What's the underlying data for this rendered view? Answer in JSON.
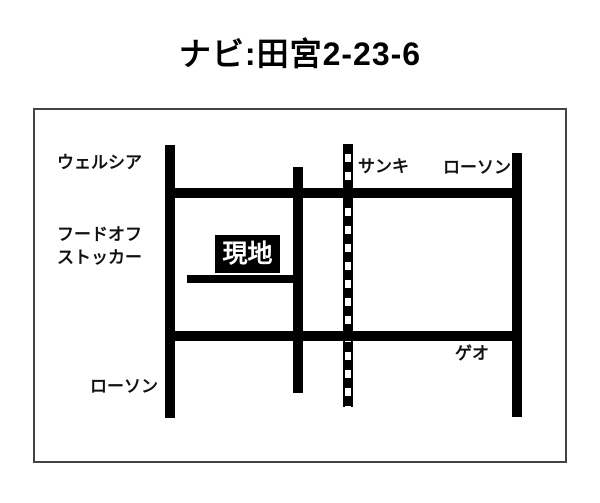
{
  "title": "ナビ:田宮2-23-6",
  "map": {
    "destination": {
      "label": "現地"
    },
    "landmarks": {
      "welcia": {
        "label": "ウェルシア"
      },
      "food_off_stocker": {
        "label_line1": "フードオフ",
        "label_line2": "ストッカー"
      },
      "lawson_bottom_left": {
        "label": "ローソン"
      },
      "sanki": {
        "label": "サンキ"
      },
      "lawson_top_right": {
        "label": "ローソン"
      },
      "geo": {
        "label": "ゲオ"
      }
    },
    "colors": {
      "background": "#ffffff",
      "road": "#000000",
      "railway": "#000000",
      "text": "#111111",
      "destination_bg": "#000000",
      "destination_text": "#ffffff",
      "frame_border": "#444444"
    }
  }
}
